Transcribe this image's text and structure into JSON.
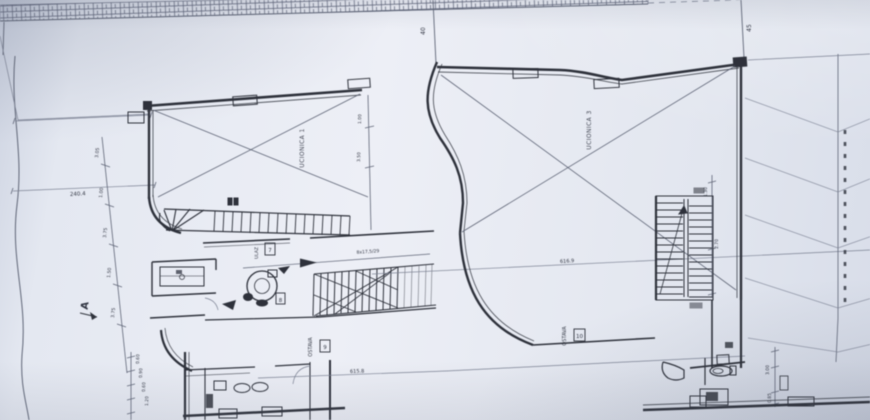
{
  "drawing": {
    "section_marker": "A",
    "grid_refs": {
      "ref1": "40",
      "ref2": "45"
    },
    "halls": {
      "left": {
        "label": "UČIONICA 1"
      },
      "right": {
        "label": "UČIONICA 3"
      }
    },
    "rooms": {
      "storage_left": {
        "label": "OSTAVA",
        "number": "9"
      },
      "storage_right": {
        "label": "OSTAVA",
        "number": "10"
      },
      "entry": {
        "label": "ULAZ",
        "number": "7"
      },
      "stair_room_number": "8"
    },
    "dims": {
      "left_line": "240.4",
      "survey_upper": "616.9",
      "survey_lower": "615.8",
      "stair_formula": "8x17,5/29",
      "left_chain": [
        "3.05",
        "1.00",
        "3.75",
        "1.50",
        "3.75"
      ],
      "bottom_chain": [
        "0.60",
        "0.90",
        "0.60",
        "1.20"
      ],
      "hall_divider_chain": [
        "1.00",
        "3.50"
      ],
      "right_wall": [
        "1.30",
        "2.70"
      ],
      "wc_chain": [
        "3.00",
        "0.85"
      ]
    }
  }
}
